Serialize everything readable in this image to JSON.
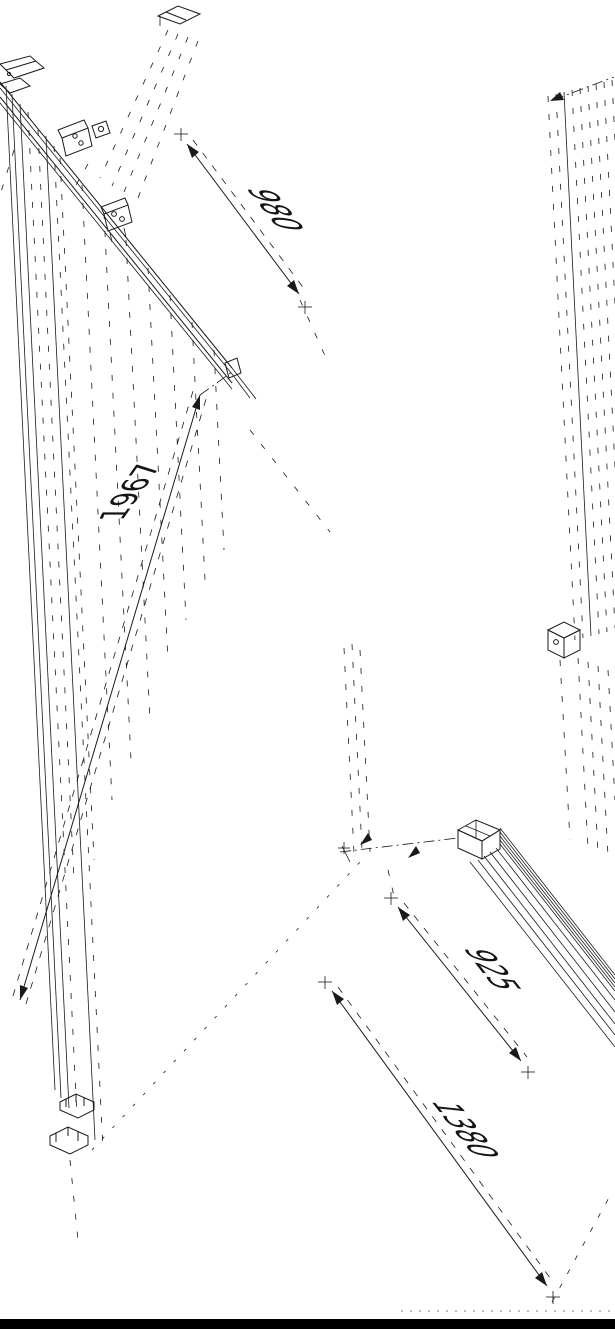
{
  "drawing": {
    "colors": {
      "background": "#ffffff",
      "line": "#1a1a1a",
      "footer_bar": "#000000"
    },
    "dimensions": [
      {
        "id": "top-rail-width",
        "value": "980"
      },
      {
        "id": "left-panel-height",
        "value": "1967"
      },
      {
        "id": "lower-panel-width",
        "value": "925"
      },
      {
        "id": "overall-width",
        "value": "1380"
      }
    ]
  }
}
